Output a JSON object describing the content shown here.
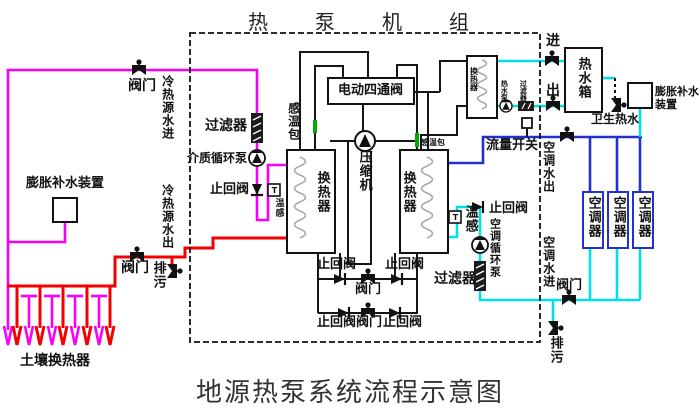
{
  "titles": {
    "top": "热泵机组",
    "bottom": "地源热泵系统流程示意图"
  },
  "left_loop": {
    "valve_top": "阀门",
    "source_in": "冷热源水进",
    "expansion": "膨胀补水装置",
    "filter": "过滤器",
    "medium_pump": "介质循环泵",
    "check_valve": "止回阀",
    "temp_sensor": "温感",
    "t_mark": "T",
    "source_out": "冷热源水出",
    "valve_bottom": "阀门",
    "drain": "排污",
    "ground_hx": "土壤换热器"
  },
  "hpu": {
    "four_way_valve": "电动四通阀",
    "bulb_left": "感温包",
    "bulb_right": "感温包",
    "compressor": "压缩机",
    "hx_left": "换热器",
    "hx_right": "换热器",
    "check_top_left": "止回阀",
    "check_top_right": "止回阀",
    "valve_mid": "阀门",
    "check_bottom_left": "止回阀",
    "valve_bottom": "阀门",
    "check_bottom_right": "止回阀"
  },
  "hot_water": {
    "hx": "换热器",
    "in": "进",
    "out": "出",
    "pump": "热水泵",
    "filter": "过滤器",
    "tank": "热水箱",
    "sanitary": "卫生热水",
    "expansion": "膨胀补水装置"
  },
  "ac_loop": {
    "flow_switch": "流量开关",
    "water_out": "空调水出",
    "temp_sensor": "温感",
    "t_mark": "T",
    "check_valve": "止回阀",
    "pump": "空调循环泵",
    "filter": "过滤器",
    "water_in": "空调水进",
    "valve": "阀门",
    "drain": "排污",
    "units": [
      "空调器",
      "空调器",
      "空调器"
    ]
  },
  "colors": {
    "magenta_pipe": "#f800f8",
    "red_pipe": "#f40000",
    "blue_pipe": "#2230cc",
    "cyan_pipe": "#00e0e6",
    "sensor_green": "#00aa00",
    "black_pipe": "#151515"
  }
}
